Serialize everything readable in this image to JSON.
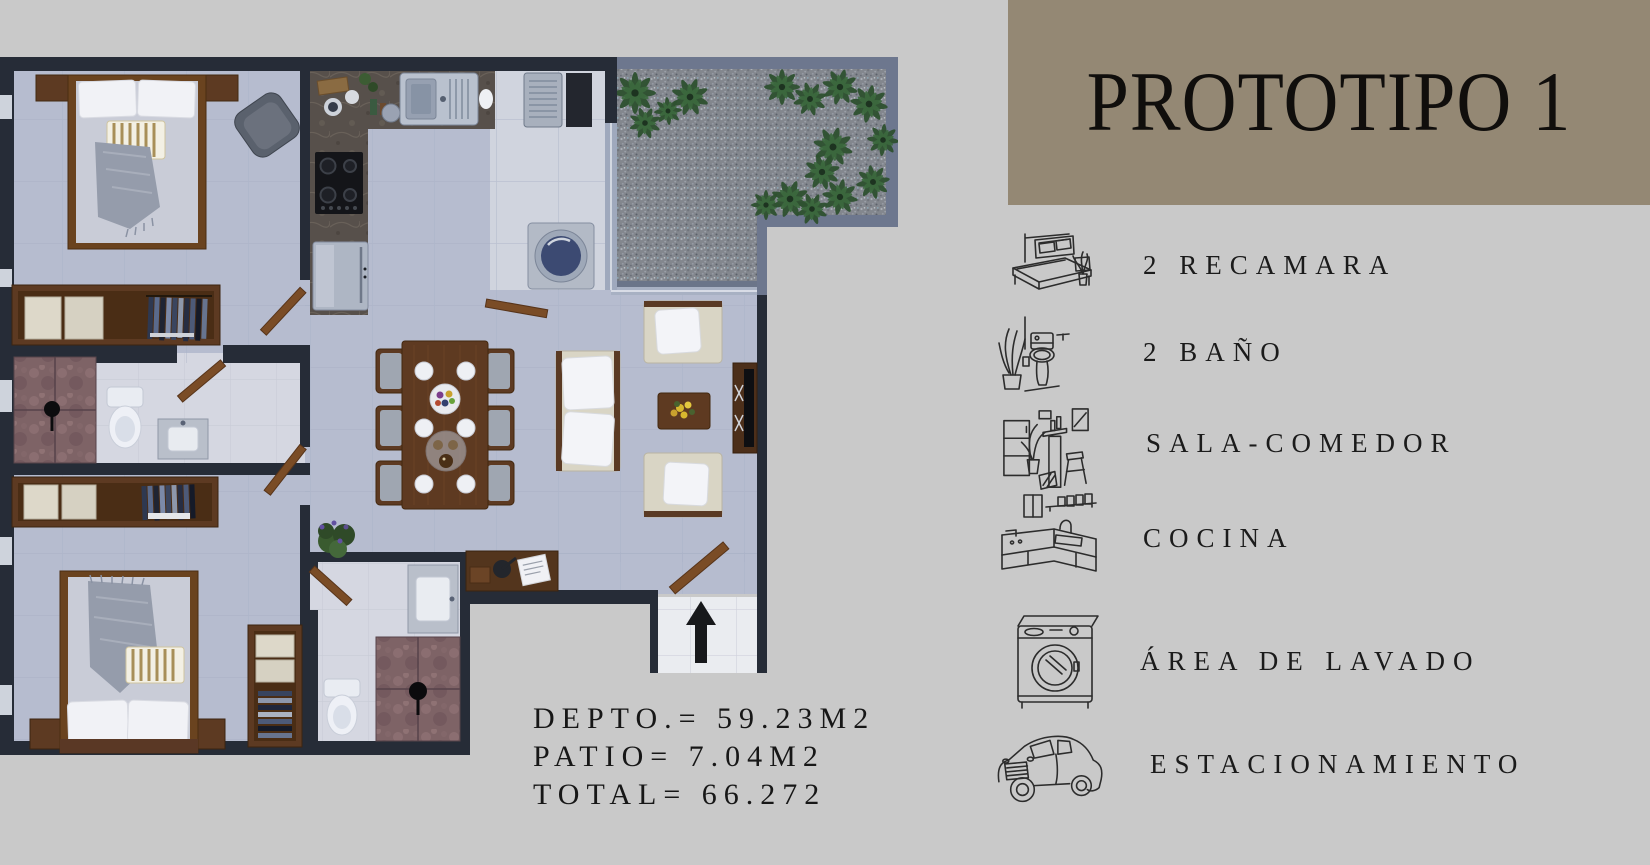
{
  "page": {
    "background_color": "#c9c9c9"
  },
  "header": {
    "title": "PROTOTIPO 1",
    "background_color": "#948874",
    "text_color": "#100e0c"
  },
  "features": [
    {
      "icon": "bed-icon",
      "label": "2 RECAMARA"
    },
    {
      "icon": "toilet-icon",
      "label": "2 BAÑO"
    },
    {
      "icon": "living-dining-icon",
      "label": "SALA-COMEDOR"
    },
    {
      "icon": "kitchen-icon",
      "label": "COCINA"
    },
    {
      "icon": "washing-machine-icon",
      "label": "ÁREA DE LAVADO"
    },
    {
      "icon": "car-icon",
      "label": "ESTACIONAMIENTO"
    }
  ],
  "measurements": {
    "depto": "DEPTO.= 59.23M2",
    "patio": "PATIO= 7.04M2",
    "total": "TOTAL= 66.272"
  },
  "floor_plan": {
    "rooms": [
      "bedroom-1",
      "bedroom-2",
      "bathroom-1",
      "bathroom-2",
      "kitchen",
      "laundry",
      "living-dining",
      "patio",
      "entrance"
    ],
    "wall_color": "#262c37",
    "floor_color": "#b8bed1",
    "patio_border_color": "#6d778e"
  }
}
